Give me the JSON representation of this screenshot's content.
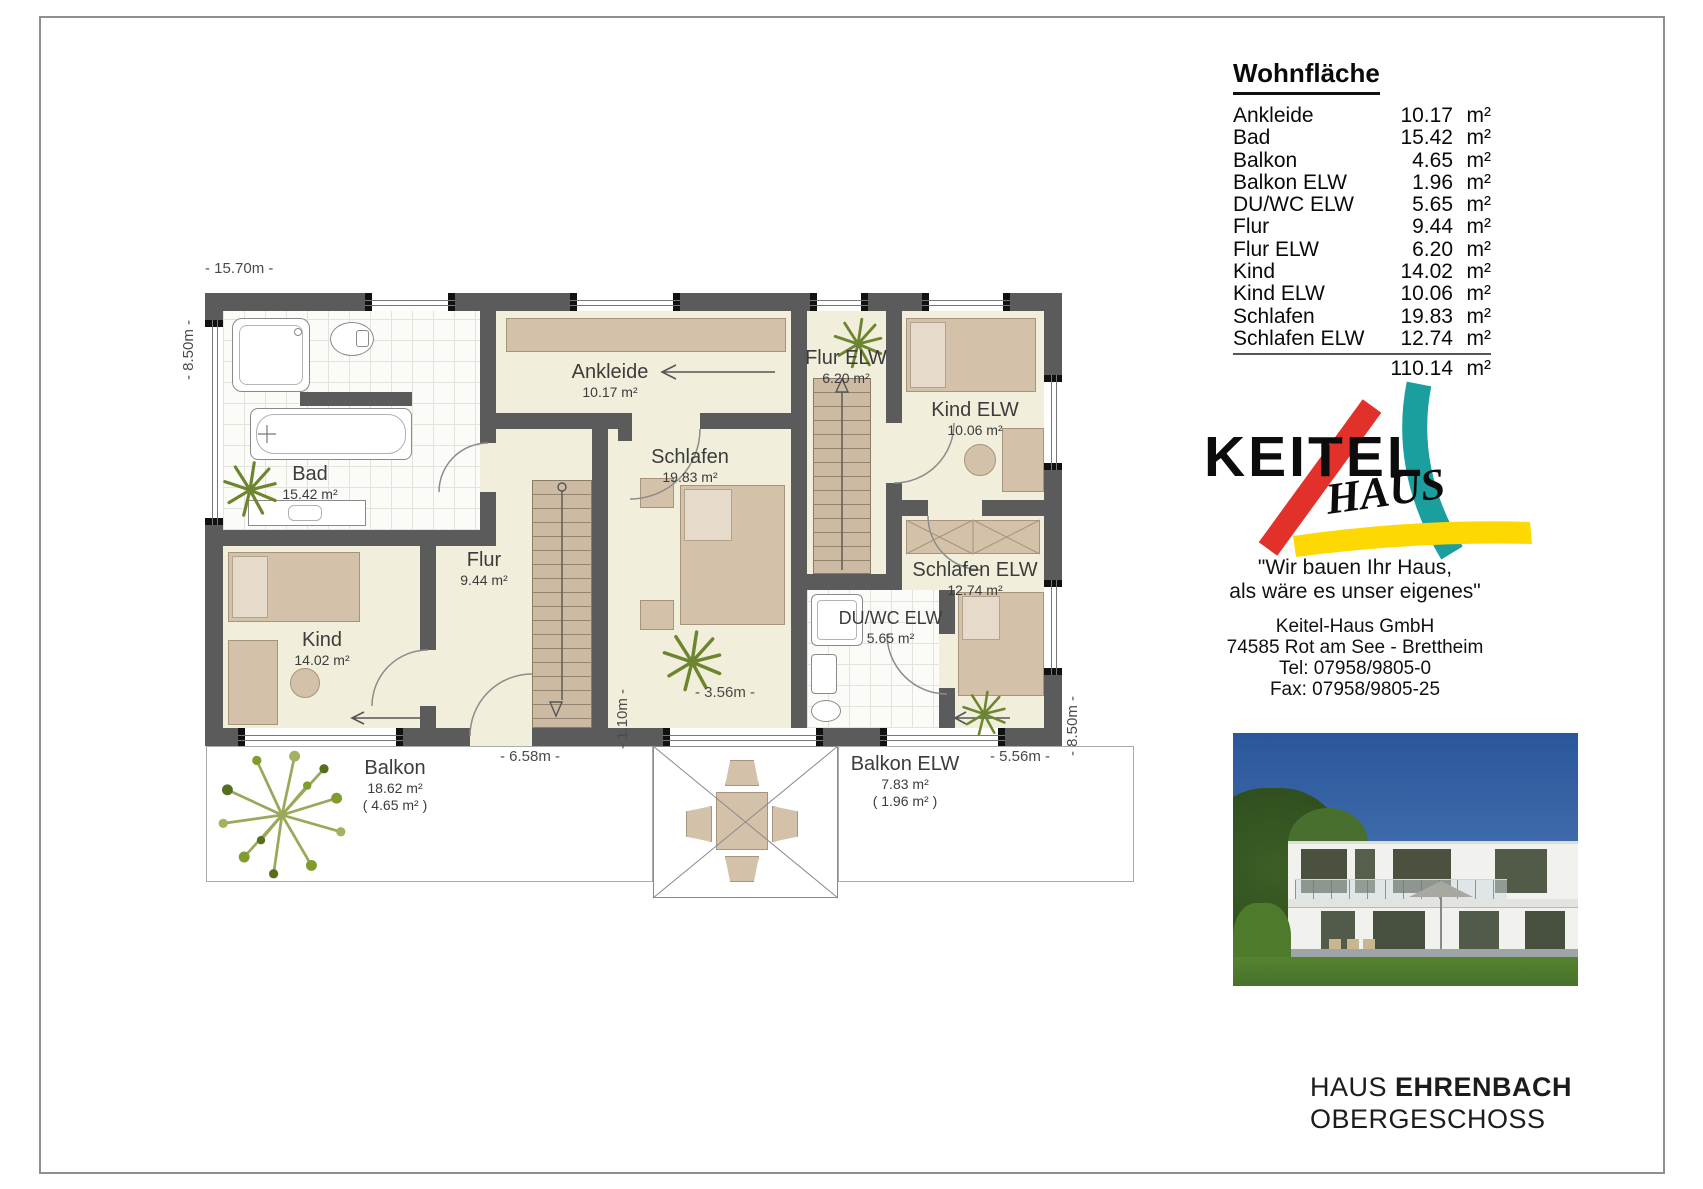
{
  "plan": {
    "dims": {
      "width_top": "- 15.70m -",
      "height_left": "- 8.50m -",
      "height_right": "- 8.50m -",
      "terrace_width": "- 3.56m -",
      "terrace_depth": "- 1.10m -",
      "balkon_width": "- 6.58m -",
      "balkon_elw_width": "- 5.56m -"
    },
    "rooms": {
      "bad": {
        "name": "Bad",
        "area": "15.42 m²"
      },
      "ankleide": {
        "name": "Ankleide",
        "area": "10.17 m²"
      },
      "schlafen": {
        "name": "Schlafen",
        "area": "19.83 m²"
      },
      "flur": {
        "name": "Flur",
        "area": "9.44 m²"
      },
      "kind": {
        "name": "Kind",
        "area": "14.02 m²"
      },
      "flur_elw": {
        "name": "Flur ELW",
        "area": "6.20 m²"
      },
      "kind_elw": {
        "name": "Kind ELW",
        "area": "10.06 m²"
      },
      "schlafen_elw": {
        "name": "Schlafen ELW",
        "area": "12.74 m²"
      },
      "duwc_elw": {
        "name": "DU/WC ELW",
        "area": "5.65 m²"
      },
      "balkon": {
        "name": "Balkon",
        "area": "18.62 m²",
        "area2": "( 4.65 m² )"
      },
      "balkon_elw": {
        "name": "Balkon ELW",
        "area": "7.83 m²",
        "area2": "( 1.96 m² )"
      }
    }
  },
  "area_table": {
    "title": "Wohnfläche",
    "rows": [
      {
        "label": "Ankleide",
        "value": "10.17",
        "unit": "m²"
      },
      {
        "label": "Bad",
        "value": "15.42",
        "unit": "m²"
      },
      {
        "label": "Balkon",
        "value": "4.65",
        "unit": "m²"
      },
      {
        "label": "Balkon ELW",
        "value": "1.96",
        "unit": "m²"
      },
      {
        "label": "DU/WC ELW",
        "value": "5.65",
        "unit": "m²"
      },
      {
        "label": "Flur",
        "value": "9.44",
        "unit": "m²"
      },
      {
        "label": "Flur ELW",
        "value": "6.20",
        "unit": "m²"
      },
      {
        "label": "Kind",
        "value": "14.02",
        "unit": "m²"
      },
      {
        "label": "Kind ELW",
        "value": "10.06",
        "unit": "m²"
      },
      {
        "label": "Schlafen",
        "value": "19.83",
        "unit": "m²"
      },
      {
        "label": "Schlafen ELW",
        "value": "12.74",
        "unit": "m²"
      }
    ],
    "total_value": "110.14",
    "total_unit": "m²"
  },
  "brand": {
    "logo_text": "KEITEL",
    "logo_sub": "HAUS",
    "slogan_line1": "\"Wir bauen Ihr Haus,",
    "slogan_line2": "als wäre es unser eigenes\"",
    "company": "Keitel-Haus GmbH",
    "address": "74585 Rot am See - Brettheim",
    "tel": "Tel: 07958/9805-0",
    "fax": "Fax: 07958/9805-25"
  },
  "footer": {
    "title_prefix": "HAUS ",
    "title_bold": "EHRENBACH",
    "subtitle": "OBERGESCHOSS"
  },
  "colors": {
    "wall": "#5b5b5b",
    "floor": "#f1efdb",
    "furniture": "#d4c1aa",
    "plant_green": "#6e8530",
    "logo_red": "#e2312b",
    "logo_teal": "#1b9f9e",
    "logo_yellow": "#fdd803"
  }
}
